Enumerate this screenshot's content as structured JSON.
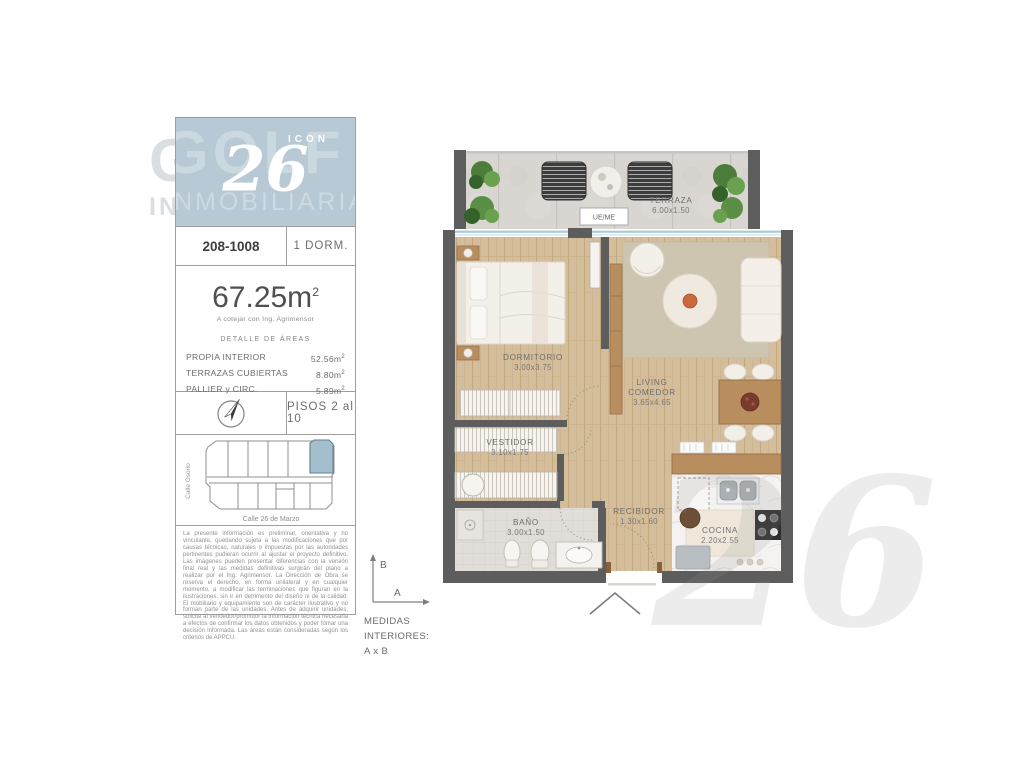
{
  "branding": {
    "logo_icon": "ICON",
    "logo_number": "26",
    "watermark_line1": "GOLF",
    "watermark_line2": "INMOBILIARIA",
    "plan_watermark": "26",
    "logo_bg_color": "#b6c9d4",
    "keyplan_highlight_color": "#a3bfce"
  },
  "unit": {
    "code": "208-1008",
    "type_label": "1 DORM."
  },
  "area": {
    "total_value": "67.25m",
    "sup": "2",
    "note": "A cotejar con Ing. Agrimensor",
    "detail_title": "DETALLE DE ÁREAS",
    "rows": [
      {
        "label": "PROPIA INTERIOR",
        "value": "52.56m"
      },
      {
        "label": "TERRAZAS CUBIERTAS",
        "value": "8.80m"
      },
      {
        "label": "PALLIER y CIRC.",
        "value": "5.89m"
      }
    ]
  },
  "floors": {
    "label": "PISOS 2 al 10"
  },
  "keyplan": {
    "street_left": "Calle Osorio",
    "street_bottom": "Calle 26 de Marzo"
  },
  "disclaimer": "La presente información es preliminar, orientativa y no vinculante, quedando sujeta a las modificaciones que por causas técnicas, naturales o impuestas por las autoridades pertinentes pudieran ocurrir al ajustar el proyecto definitivo. Las imágenes pueden presentar diferencias con la versión final real y las medidas definitivas surgirán del plano a realizar por el Ing. Agrimensor. La Dirección de Obra se reserva el derecho, en forma unilateral y en cualquier momento, a modificar las terminaciones que figuran en la ilustraciones, sin ir en detrimento del diseño ni de la calidad. El mobiliario y equipamiento son de carácter ilustrativo y no forman parte de las unidades. Antes de adquirir unidades, solicite al vendedor/promotor la información técnica necesaria a efectos de confirmar los datos obtenidos y poder tomar una decisión informada. Las áreas están consideradas según los criterios de APPCU.",
  "plan": {
    "ueme_label": "UE/ME",
    "rooms": {
      "terraza": {
        "name": "TERRAZA",
        "dims": "6.00x1.50"
      },
      "dormitorio": {
        "name": "DORMITORIO",
        "dims": "3.00x3.75"
      },
      "living": {
        "name_line1": "LIVING",
        "name_line2": "COMEDOR",
        "dims": "3.65x4.65"
      },
      "vestidor": {
        "name": "VESTIDOR",
        "dims": "3.10x1.75"
      },
      "bano": {
        "name": "BAÑO",
        "dims": "3.00x1.50"
      },
      "recibidor": {
        "name": "RECIBIDOR",
        "dims": "1.30x1.60"
      },
      "cocina": {
        "name": "COCINA",
        "dims": "2.20x2.55"
      }
    },
    "legend": {
      "vertical_axis": "B",
      "horizontal_axis": "A",
      "lines": [
        "MEDIDAS",
        "INTERIORES:",
        "A x B"
      ]
    }
  }
}
